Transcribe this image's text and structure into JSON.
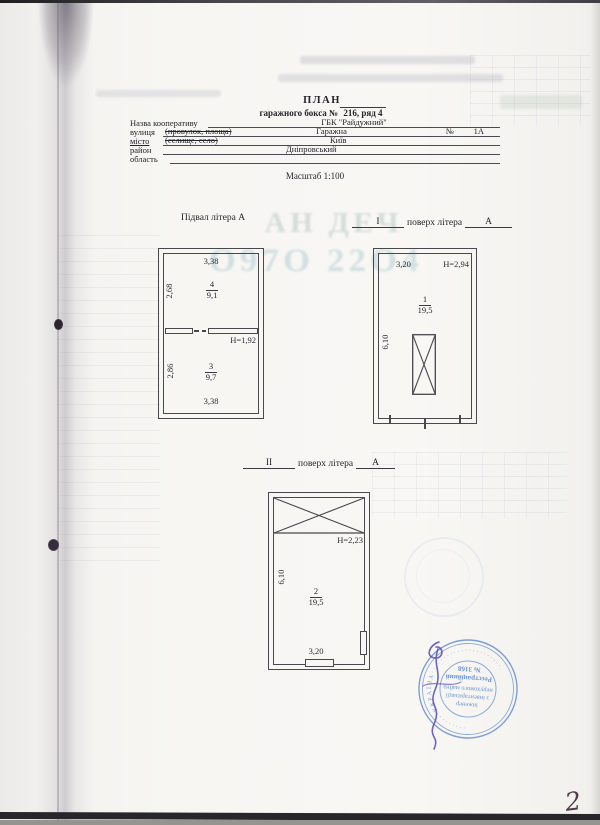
{
  "page": {
    "number": "2"
  },
  "header": {
    "title": "ПЛАН",
    "subtitle_prefix": "гаражного бокса №",
    "subtitle_value": "216, ряд 4",
    "scale": "Масштаб 1:100",
    "rows": [
      {
        "label": "Назва кооперативу",
        "strike": "",
        "value": "ГБК \"Райдужний\"",
        "num_label": "",
        "num_value": ""
      },
      {
        "label": "вулиця",
        "strike": "(провулок, площа)",
        "value": "Гаражна",
        "num_label": "№",
        "num_value": "1А"
      },
      {
        "label": "місто",
        "strike": "(селище, село)",
        "value": "Київ",
        "num_label": "",
        "num_value": ""
      },
      {
        "label": "район",
        "strike": "",
        "value": "Дніпровський",
        "num_label": "",
        "num_value": ""
      },
      {
        "label": "область",
        "strike": "",
        "value": "",
        "num_label": "",
        "num_value": ""
      }
    ]
  },
  "plans": {
    "basement": {
      "title": "Підвал літера А",
      "dim_top": "3,38",
      "dim_left_top": "2,68",
      "room_top_num": "4",
      "room_top_area": "9,1",
      "door_height": "H=1,92",
      "dim_left_bottom": "2,86",
      "room_bottom_num": "3",
      "room_bottom_area": "9,7",
      "dim_bottom": "3,38"
    },
    "floor1": {
      "blank": "I",
      "label": "поверх літера",
      "letter": "А",
      "dim_top": "3,20",
      "height": "H=2,94",
      "room_num": "1",
      "room_area": "19,5",
      "dim_left": "6,10"
    },
    "floor2": {
      "blank": "II",
      "label": "поверх літера",
      "letter": "А",
      "height": "H=2,23",
      "dim_left": "6,10",
      "room_num": "2",
      "room_area": "19,5",
      "dim_bottom": "3,20"
    }
  },
  "stamp": {
    "ring_text": "· · · · · · · · ·  У К Р А Ї Н А  · · · · · · · · · · · · · · · · · · · · · ·",
    "center_lines": [
      "інженер",
      "з інвентаризації",
      "нерухомого майна",
      "Реєстраційний",
      "№ 3168"
    ],
    "color": "#4b79c9"
  },
  "artifacts": {
    "watermark_row1": "АН ДЕЧ",
    "watermark_row2": "О97О 22О4"
  }
}
